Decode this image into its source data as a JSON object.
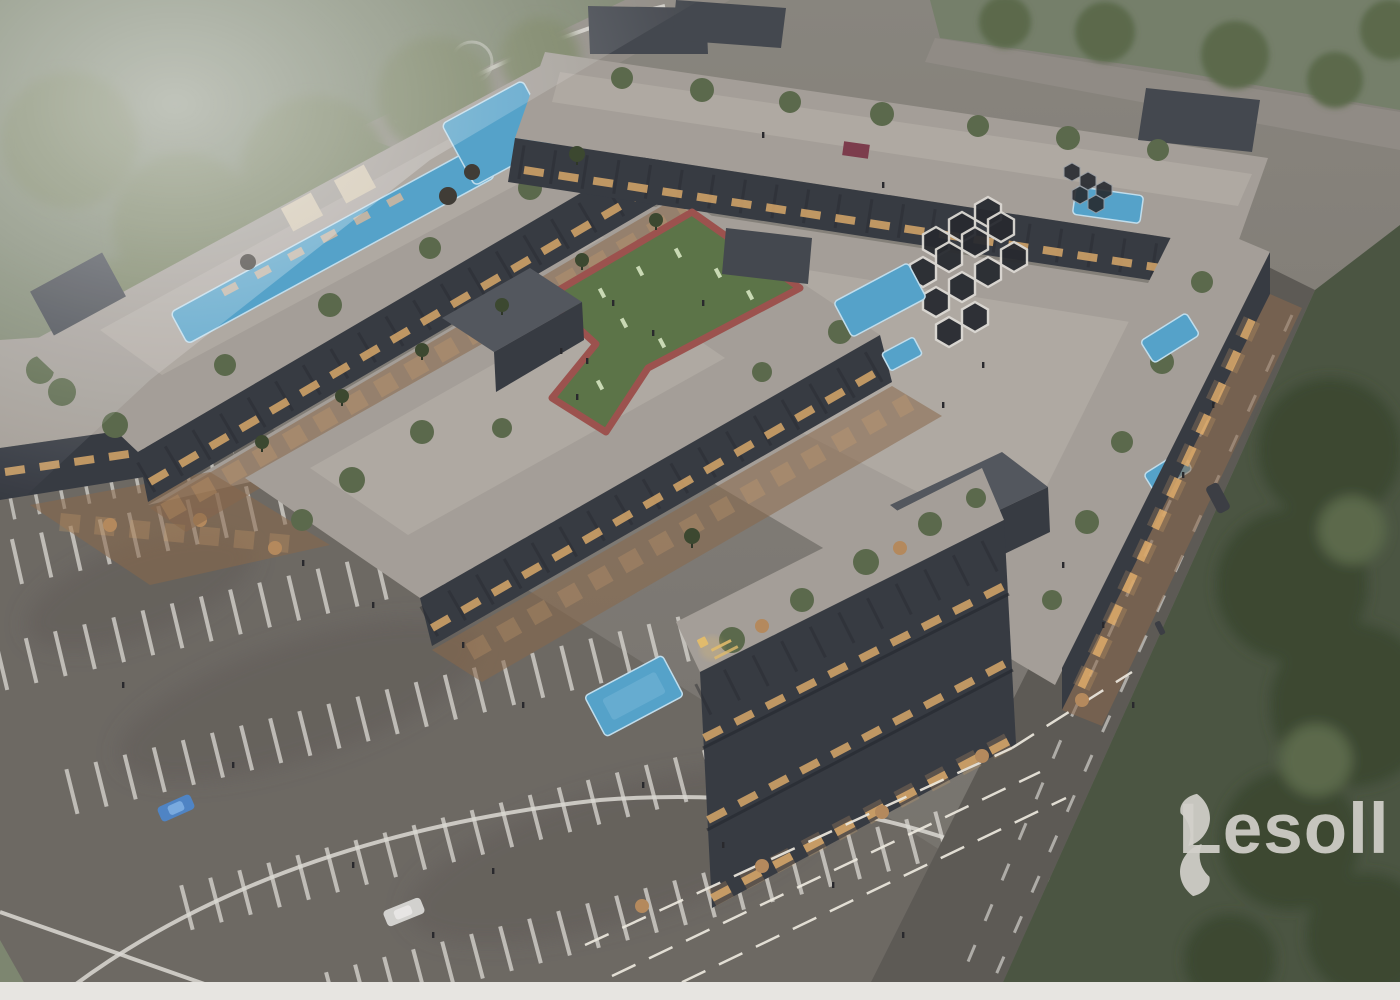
{
  "title": "Aerial dusk 3D render of a mixed-use commercial plaza complex",
  "watermark": {
    "brand": "Lesoll",
    "icon": "lesoll-swirl-icon"
  },
  "scene": {
    "time_of_day": "dusk",
    "view": "high-angle aerial perspective",
    "features": [
      "dark modern low-rise commercial buildings arranged around courtyards",
      "rooftop lap pool with sun deck and loungers",
      "rooftop outdoor gym on green turf with red running track",
      "hexagonal honeycomb shade canopy over plaza seating",
      "courtyard plunge pools and water features",
      "warm-lit outdoor dining terraces along shopfronts",
      "gold-lit building signage",
      "surface parking lot with white bay markings and curved lane lines",
      "perimeter streets with dashed lane markings and pedestrians",
      "landscaped lawns, palm trees and large tree canopies",
      "hazy mist over the top-left greenery"
    ]
  },
  "vehicles": [
    {
      "type": "sedan",
      "color": "blue",
      "location": "parking lot"
    },
    {
      "type": "van",
      "color": "white",
      "location": "parking lot"
    },
    {
      "type": "car",
      "color": "dark grey",
      "location": "right street"
    }
  ],
  "colors": {
    "ground": "#837f78",
    "ground-low": "#78746d",
    "green-nw": "#7f8870",
    "green-ne": "#76816a",
    "green-right": "#4a5540",
    "tree": "#5b6a4a",
    "tree-dark": "#3a472d",
    "tree-hazy": "#77815f",
    "asphalt": "#6e6a63",
    "asphalt-dark": "#605c56",
    "road": "#938e86",
    "street": "#5d5a54",
    "paving": "#a8a29a",
    "paving-light": "#b6b0a7",
    "deck": "#8a6848",
    "facade": "#353940",
    "facade-dark": "#25282d",
    "box": "#43474d",
    "box-top": "#53575d",
    "pool": "#55a6ce",
    "pool-edge": "#c6e4f3",
    "turf": "#5c7546",
    "track": "#a0524c",
    "gym-eq": "#cfe0b8",
    "amber": "#e9b36c",
    "led": "#f4f0e4",
    "white-line": "#e2dfd8",
    "person": "#26262a",
    "maroon": "#7e3a4a",
    "cream": "#d9cdb4",
    "lounger": "#c4b9a8",
    "umbrella": "#b98c5c",
    "umbrella-dark": "#3f3a33",
    "sign-gold": "#e8c06c",
    "car-blue": "#4f86c9",
    "car-white": "#d9d7d3",
    "car-dark": "#3a3d42",
    "watermark": "#d2d0ca",
    "bottom-band": "#e7e5e1"
  }
}
